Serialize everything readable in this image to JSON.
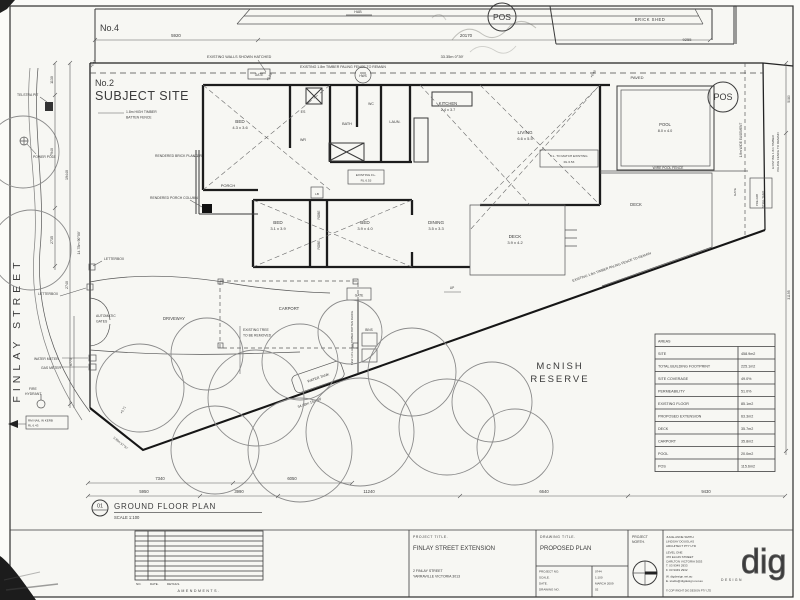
{
  "neighbour": {
    "no4": "No.4",
    "hab": "HAB",
    "brick_shed": "BRICK SHED",
    "pos": "POS"
  },
  "site": {
    "no2": "No.2",
    "subject": "SUBJECT SITE",
    "street": "FINLAY STREET",
    "reserve1": "McNISH",
    "reserve2": "RESERVE",
    "paved": "PAVED",
    "pos": "POS"
  },
  "rooms": {
    "bed": "BED",
    "bed1_size": "4.3 x 3.6",
    "es": "ES",
    "wr": "WR",
    "bath": "BATH",
    "wc": "WC",
    "laun": "LAUN.",
    "kitchen": "KITCHEN",
    "kitchen_size": "2.4 x 3.7",
    "living": "LIVING",
    "living_size": "6.6 x 5.5",
    "bed2_size": "3.1 x 3.9",
    "bed3_size": "3.9 x 4.0",
    "dining": "DINING",
    "dining_size": "3.5 x 3.3",
    "deck": "DECK",
    "deck_size": "3.9 x 4.2",
    "robe": "ROBE",
    "lb": "LB",
    "porch": "PORCH",
    "up": "UP",
    "fl_existing1": "EXISTING F.L.",
    "fl_existing2": "RL 6.53",
    "fl_match1": "F.L. TO MATCH EXISTING",
    "fl_match2": "RL 6.53"
  },
  "outdoor": {
    "carport": "CARPORT",
    "driveway": "DRIVEWAY",
    "gate": "GATE",
    "bins": "BINS",
    "water_tank": "WATER TANK",
    "pool": "POOL",
    "pool_size": "8.0 x 4.0",
    "wire_pool_fence": "WIRE POOL FENCE",
    "deck": "DECK",
    "prefab1": "PRE-FAB",
    "prefab2": "STEEL SHED",
    "easement": "1.8m WIDE EASEMENT",
    "hws": "HWS"
  },
  "annotations": {
    "existing_walls": "EXISTING WALLS SHOWN HATCHED",
    "paling_fence": "EXISTING 1.8m TIMBER PALING FENCE TO REMAIN",
    "paling_fence_r1": "EXISTING 1.8m TIMBER",
    "paling_fence_r2": "PALING FENCE TO REMAIN",
    "batten1": "1.8m HIGH TIMBER",
    "batten2": "BATTEN FENCE",
    "new_batten": "NEW 1.8m HIGH TIMBER BATTEN FENCE",
    "planter": "RENDERED BRICK PLANTER",
    "column": "RENDERED PORCH COLUMN",
    "letterbox": "LETTERBOX",
    "auto1": "AUTOMATIC",
    "auto2": "GATES",
    "water_meter": "WATER METER",
    "gas_meter": "GAS METER",
    "fire1": "FIRE",
    "fire2": "HYDRANT",
    "rm1": "RM NAIL IN KERB",
    "rm2": "RL 6.43",
    "telstra": "TELSTRA PIT",
    "power": "POWER POLE",
    "tree1": "EXISTING TREE",
    "tree2": "TO BE REMOVED"
  },
  "levels": {
    "l1": "+6.47",
    "l2": "+6.10",
    "l3": "+6.40",
    "l4": "+5.71"
  },
  "dims": {
    "d5920": "5920",
    "d20170": "20170",
    "d9255": "9255",
    "bearing_top": "33.35m  0°39'",
    "bearing_diag": "34.68m  152°49'",
    "bearing_left": "14.78m  90°00'",
    "bearing_sw": "3.99m  57°57'",
    "d1130": "1130",
    "d7940": "7940",
    "d2735": "2735",
    "d19440": "19440",
    "d2740": "2740",
    "d6775": "6775",
    "d7340": "7340",
    "d6050": "6050",
    "d5950": "5950",
    "d3990": "3990",
    "d11240": "11240",
    "d6640": "6640",
    "d9430": "9430",
    "d5080": "5080",
    "d31195": "31195"
  },
  "areas": {
    "rows": [
      {
        "label": "AREAS",
        "value": ""
      },
      {
        "label": "SITE",
        "value": "458.9m2"
      },
      {
        "label": "TOTAL BUILDING FOOTPRINT",
        "value": "225.1m2"
      },
      {
        "label": "SITE COVERAGE",
        "value": "49.0%"
      },
      {
        "label": "PERMEABILITY",
        "value": "51.0%"
      },
      {
        "label": "EXISTING FLOOR",
        "value": "85.1m2"
      },
      {
        "label": "PROPOSED EXTENSION",
        "value": "63.3m2"
      },
      {
        "label": "DECK",
        "value": "35.7m2"
      },
      {
        "label": "CARPORT",
        "value": "35.8m2"
      },
      {
        "label": "POOL",
        "value": "20.0m2"
      },
      {
        "label": "POS",
        "value": "115.6m2"
      }
    ]
  },
  "callout": {
    "num": "01",
    "title": "GROUND FLOOR PLAN",
    "scale": "SCALE 1:100"
  },
  "titleblock": {
    "no": "NO.",
    "date": "DATE.",
    "details": "DETAILS.",
    "amendments": "AMENDMENTS.",
    "project_title_label": "PROJECT TITLE.",
    "project_title": "FINLAY STREET EXTENSION",
    "address1": "2 FINLAY STREET",
    "address2": "YARRAVILLE VICTORIA 3013",
    "drawing_title_label": "DRAWING TITLE.",
    "drawing_title": "PROPOSED PLAN",
    "meta": [
      {
        "label": "PROJECT NO.",
        "value": "0744"
      },
      {
        "label": "SCALE.",
        "value": "1:100"
      },
      {
        "label": "DATE.",
        "value": "MARCH 2009"
      },
      {
        "label": "DRAWING NO.",
        "value": "02"
      }
    ],
    "north1": "PROJECT",
    "north2": "NORTH.",
    "firm": [
      "JULIE-ANNE SMITH",
      "LINDSAY DOUGLAS",
      "ARCHITECT PTY LTD",
      "LEVEL ONE",
      "476 ELGIN STREET",
      "CARLTON VICTORIA 3053",
      "T. 03 9349 2933",
      "F. 03 9349 2932",
      "W. digdesign.net.au",
      "E. studio@digdesign.net.au"
    ],
    "copyright": "© COPYRIGHT DIG DESIGN PTY LTD",
    "logo": "dig",
    "logo_sub": "DESIGN"
  }
}
